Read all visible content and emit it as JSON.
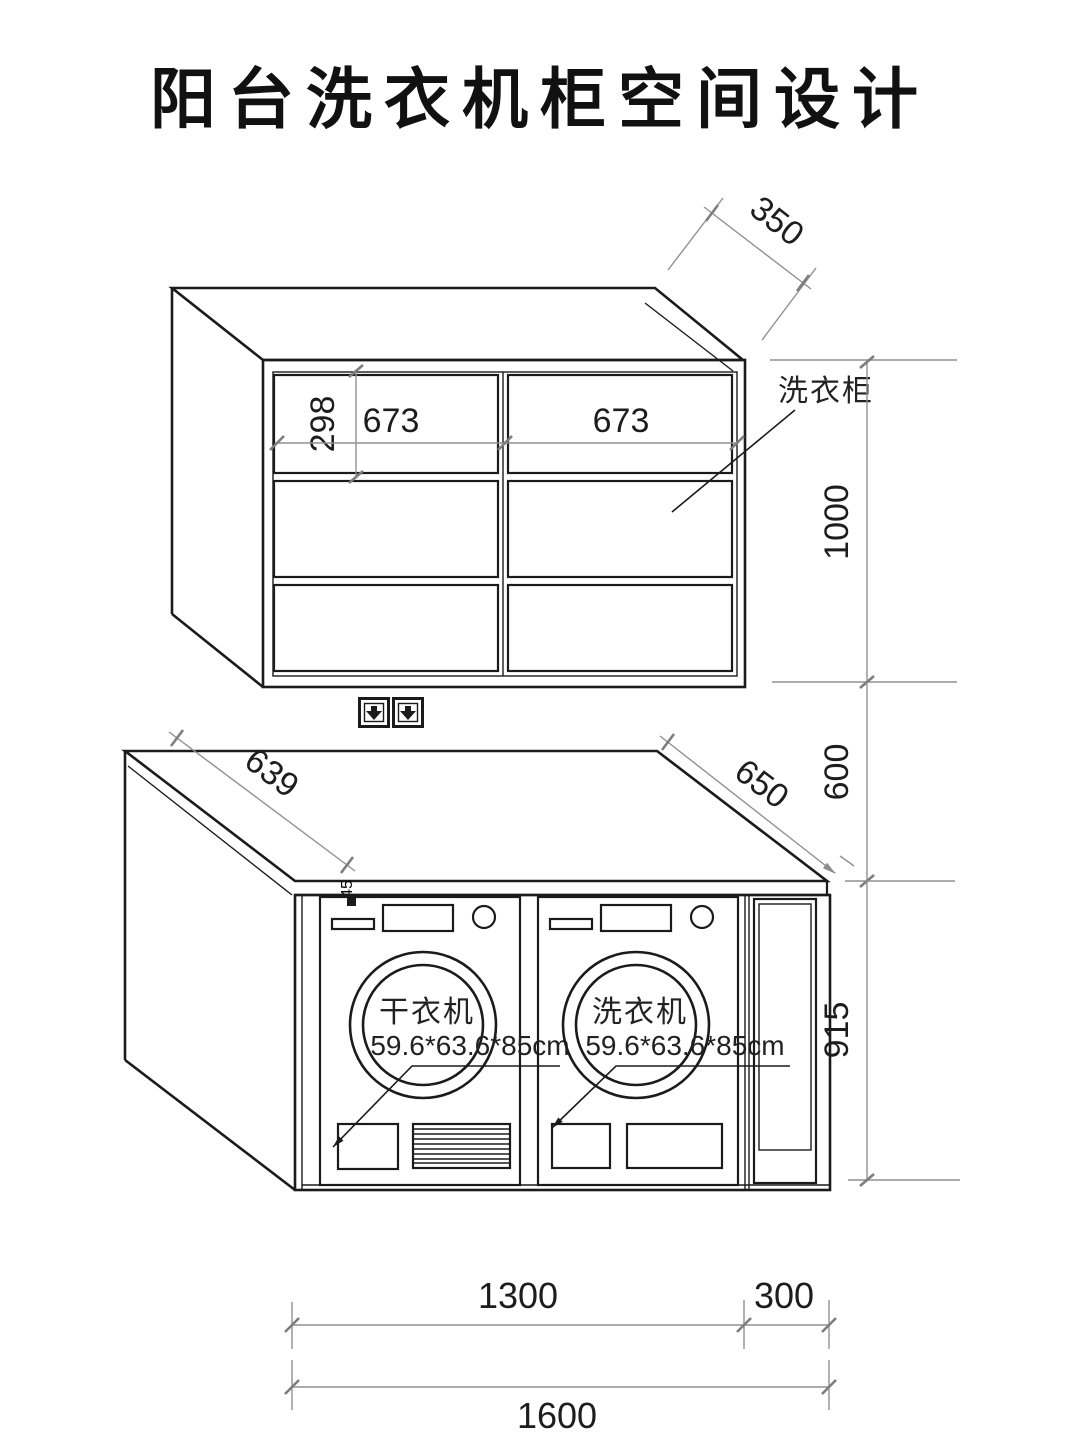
{
  "title": "阳台洗衣机柜空间设计",
  "upper_cabinet": {
    "label": "洗衣柜",
    "depth": "350",
    "top_row_height": "298",
    "left_door_width": "673",
    "right_door_width": "673",
    "height": "1000"
  },
  "gap": {
    "height": "600"
  },
  "counter": {
    "thickness": "45",
    "depth_left": "639",
    "depth_right": "650"
  },
  "lower_unit": {
    "height": "915",
    "dryer": {
      "label": "干衣机",
      "size": "59.6*63.6*85cm"
    },
    "washer": {
      "label": "洗衣机",
      "size": "59.6*63.6*85cm"
    },
    "machines_width": "1300",
    "side_cabinet_width": "300",
    "total_width": "1600"
  },
  "colors": {
    "line": "#1b1b1b",
    "dimension": "#909090",
    "background": "#ffffff"
  }
}
